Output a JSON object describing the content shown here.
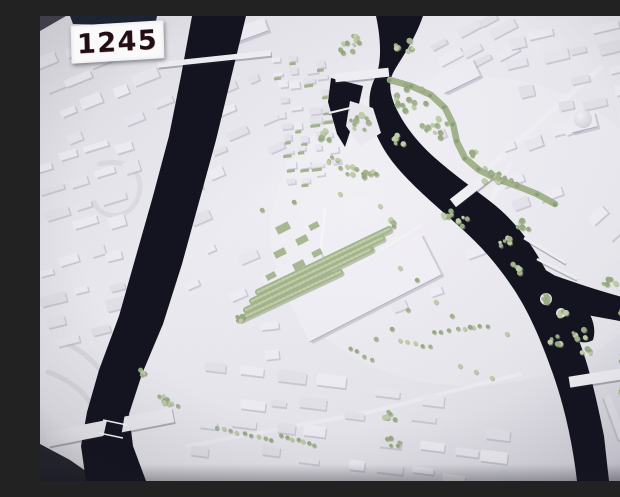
{
  "label": {
    "text": "1245"
  },
  "colors": {
    "base": "#e9e8ee",
    "base_light": "#f4f3f8",
    "base_dark": "#d9d8e0",
    "water": "#131420",
    "building": "#f1f0f6",
    "building_alt": "#ebeaf1",
    "building_dim": "#e6e5ec",
    "building_shadow": "#b4b3c1",
    "tree": "#a4b58e",
    "tree_light": "#c2cfa9",
    "tree_dark": "#879a72",
    "bridge": "#f2f1f6",
    "road": "#f7f6fa",
    "ramp": "#d9d8e0",
    "plaque": "#1e2433",
    "vignette": "#15161e",
    "card": "#fafafb",
    "card_text": "#220f16"
  },
  "scene": {
    "water": {
      "canal": "M152,0 L206,0 L191,62 L176,124 L159,186 L142,248 L123,308 L102,358 L89,398 L93,430 L106,465 L46,465 L41,430 L47,396 L59,354 L79,300 L96,240 L113,180 L129,120 L141,60 Z",
      "river": "M336,0 L383,0 C374,26 360,44 353,57 C348,67 350,80 357,94 C365,110 377,126 395,142 C413,158 433,172 451,186 C469,200 485,218 499,242 C513,266 526,292 538,322 C550,352 558,390 564,420 L569,465 L537,465 C533,430 525,392 513,358 C501,324 489,296 473,272 C457,248 441,230 421,212 C401,194 379,176 361,156 C345,138 335,120 331,102 C328,88 329,74 335,62 C341,50 342,28 336,0 Z",
      "lagoon": "M468,248 C488,242 514,256 530,272 C548,290 558,308 553,324 C541,332 519,318 503,306 C487,294 472,270 468,248 Z",
      "right_branch": "M505,256 C530,265 556,274 582,281 C596,285 610,288 620,291 L620,317 C604,311 587,306 569,303 C547,299 524,295 508,288 Z",
      "harbor": "M291,62 L323,70 L319,88 L305,131 L297,118 L288,86 Z",
      "lock_channel": "M69,395 L85,397 L79,433 L61,431 Z"
    },
    "islands": {
      "wedge": "M310,85 L333,92 L341,117 L320,130 L306,110 Z",
      "islets": [
        [
          506,
          283,
          6
        ],
        [
          521,
          297,
          5
        ]
      ]
    },
    "districts": [
      {
        "id": "top-left",
        "x": 2,
        "y": 10,
        "w": 118,
        "h": 110,
        "angle": -22,
        "cols": 4,
        "rows": 4,
        "bw": 20,
        "bh": 8,
        "density": 0.8,
        "seed": 11
      },
      {
        "id": "left-mid",
        "x": 0,
        "y": 125,
        "w": 115,
        "h": 115,
        "angle": -17,
        "cols": 4,
        "rows": 5,
        "bw": 21,
        "bh": 8,
        "density": 0.8,
        "seed": 12
      },
      {
        "id": "left-lower",
        "x": 0,
        "y": 240,
        "w": 100,
        "h": 90,
        "angle": -14,
        "cols": 3,
        "rows": 4,
        "bw": 20,
        "bh": 8,
        "density": 0.7,
        "seed": 13
      },
      {
        "id": "canal-east-upper",
        "x": 152,
        "y": 58,
        "w": 100,
        "h": 125,
        "angle": -23,
        "cols": 3,
        "rows": 5,
        "bw": 16,
        "bh": 7,
        "density": 0.6,
        "seed": 14
      },
      {
        "id": "canal-east-lower",
        "x": 135,
        "y": 188,
        "w": 92,
        "h": 110,
        "angle": -23,
        "cols": 3,
        "rows": 4,
        "bw": 15,
        "bh": 7,
        "density": 0.55,
        "seed": 15
      },
      {
        "id": "old-town",
        "x": 238,
        "y": 32,
        "w": 58,
        "h": 136,
        "angle": -7,
        "cols": 4,
        "rows": 10,
        "bw": 9,
        "bh": 5,
        "density": 0.85,
        "seed": 16,
        "greens": true
      },
      {
        "id": "top-center",
        "x": 393,
        "y": 2,
        "w": 85,
        "h": 55,
        "angle": -28,
        "cols": 3,
        "rows": 3,
        "bw": 22,
        "bh": 7,
        "density": 0.7,
        "seed": 17
      },
      {
        "id": "top-right",
        "x": 470,
        "y": 0,
        "w": 150,
        "h": 120,
        "angle": -13,
        "cols": 5,
        "rows": 5,
        "bw": 20,
        "bh": 8,
        "density": 0.78,
        "seed": 18
      },
      {
        "id": "right-mid",
        "x": 568,
        "y": 168,
        "w": 52,
        "h": 100,
        "angle": -42,
        "cols": 2,
        "rows": 4,
        "bw": 16,
        "bh": 7,
        "density": 0.7,
        "seed": 19
      },
      {
        "id": "right-low",
        "x": 572,
        "y": 325,
        "w": 48,
        "h": 138,
        "angle": 70,
        "cols": 2,
        "rows": 5,
        "bw": 22,
        "bh": 7,
        "density": 0.8,
        "seed": 20
      },
      {
        "id": "bottom-center",
        "x": 152,
        "y": 358,
        "w": 325,
        "h": 104,
        "angle": 7,
        "cols": 9,
        "rows": 4,
        "bw": 22,
        "bh": 8,
        "density": 0.72,
        "seed": 21
      },
      {
        "id": "center-east",
        "x": 342,
        "y": 228,
        "w": 125,
        "h": 100,
        "angle": -20,
        "cols": 3,
        "rows": 3,
        "bw": 16,
        "bh": 7,
        "density": 0.4,
        "seed": 22
      },
      {
        "id": "river-bend-inside",
        "x": 348,
        "y": 98,
        "w": 70,
        "h": 62,
        "angle": -25,
        "cols": 2,
        "rows": 3,
        "bw": 12,
        "bh": 6,
        "density": 0.4,
        "seed": 23
      },
      {
        "id": "east-of-river",
        "x": 452,
        "y": 108,
        "w": 105,
        "h": 80,
        "angle": -20,
        "cols": 3,
        "rows": 3,
        "bw": 18,
        "bh": 7,
        "density": 0.6,
        "seed": 24
      },
      {
        "id": "canal-delta",
        "x": 150,
        "y": 300,
        "w": 105,
        "h": 55,
        "angle": -6,
        "cols": 3,
        "rows": 2,
        "bw": 18,
        "bh": 7,
        "density": 0.5,
        "seed": 25
      }
    ],
    "landmarks": [
      {
        "id": "station-hall",
        "cx": 325,
        "cy": 272,
        "w": 148,
        "h": 46,
        "rot": -27
      },
      {
        "id": "station-annex",
        "cx": 255,
        "cy": 258,
        "w": 64,
        "h": 26,
        "rot": -27
      },
      {
        "id": "dome-base",
        "cx": 543,
        "cy": 106,
        "w": 26,
        "h": 16,
        "rot": -14
      },
      {
        "id": "tall-slab",
        "cx": 152,
        "cy": 162,
        "w": 14,
        "h": 24,
        "rot": -18
      },
      {
        "id": "big-block",
        "cx": 210,
        "cy": 14,
        "w": 34,
        "h": 14,
        "rot": -20
      },
      {
        "id": "white-hall",
        "cx": 418,
        "cy": 60,
        "w": 40,
        "h": 20,
        "rot": -26
      }
    ],
    "dome": {
      "cx": 543,
      "cy": 103,
      "r": 9
    },
    "bridges": [
      {
        "id": "canal-bridge",
        "cx": 174,
        "cy": 43,
        "w": 114,
        "h": 5.5,
        "rot": -6
      },
      {
        "id": "upper-bridge",
        "cx": 322,
        "cy": 59,
        "w": 54,
        "h": 9,
        "rot": -6
      },
      {
        "id": "central-bridge",
        "cx": 431,
        "cy": 173,
        "w": 46,
        "h": 10,
        "rot": -38
      },
      {
        "id": "lower-bridge",
        "cx": 562,
        "cy": 361,
        "w": 66,
        "h": 11,
        "rot": -9
      },
      {
        "id": "lock-road",
        "cx": 70,
        "cy": 411,
        "w": 128,
        "h": 15,
        "rot": -11
      }
    ],
    "footbridges": [
      [
        484,
        222,
        526,
        247,
        2.5
      ],
      [
        497,
        243,
        537,
        263,
        2.5
      ],
      [
        600,
        277,
        614,
        306,
        4
      ],
      [
        289,
        97,
        310,
        92,
        2
      ]
    ],
    "lock_gates": [
      [
        63,
        404,
        87,
        409,
        1.6
      ],
      [
        59,
        417,
        83,
        422,
        1.6
      ]
    ],
    "green_strips": [
      [
        218,
        276,
        349,
        213
      ],
      [
        212,
        285,
        342,
        222
      ],
      [
        206,
        294,
        331,
        233
      ],
      [
        202,
        302,
        300,
        256
      ]
    ],
    "allee": [
      [
        350,
        64
      ],
      [
        371,
        70
      ],
      [
        391,
        79
      ],
      [
        405,
        92
      ],
      [
        413,
        108
      ],
      [
        417,
        126
      ],
      [
        425,
        142
      ],
      [
        439,
        154
      ],
      [
        457,
        163
      ],
      [
        477,
        170
      ],
      [
        497,
        178
      ],
      [
        515,
        188
      ]
    ],
    "tree_rows": [
      [
        176,
        412,
        232,
        424,
        9
      ],
      [
        241,
        420,
        275,
        429,
        7
      ],
      [
        394,
        316,
        448,
        310,
        8
      ],
      [
        310,
        332,
        331,
        344,
        4
      ],
      [
        360,
        325,
        390,
        331,
        5
      ],
      [
        444,
        152,
        477,
        167,
        6
      ],
      [
        585,
        250,
        612,
        262,
        5
      ],
      [
        120,
        381,
        138,
        390,
        4
      ]
    ],
    "tree_clusters": [
      [
        310,
        28,
        14,
        11
      ],
      [
        364,
        30,
        10,
        7
      ],
      [
        318,
        106,
        12,
        9
      ],
      [
        285,
        120,
        7,
        5
      ],
      [
        293,
        146,
        7,
        5
      ],
      [
        372,
        82,
        18,
        14
      ],
      [
        394,
        112,
        14,
        10
      ],
      [
        358,
        122,
        10,
        7
      ],
      [
        308,
        152,
        9,
        7
      ],
      [
        331,
        161,
        9,
        6
      ],
      [
        452,
        160,
        11,
        8
      ],
      [
        408,
        198,
        8,
        6
      ],
      [
        424,
        207,
        8,
        5
      ],
      [
        462,
        226,
        9,
        6
      ],
      [
        479,
        252,
        8,
        6
      ],
      [
        506,
        283,
        6,
        5
      ],
      [
        521,
        297,
        5,
        4
      ],
      [
        540,
        318,
        8,
        6
      ],
      [
        515,
        325,
        7,
        5
      ],
      [
        570,
        268,
        7,
        5
      ],
      [
        589,
        273,
        6,
        4
      ],
      [
        578,
        297,
        6,
        4
      ],
      [
        546,
        336,
        6,
        4
      ],
      [
        585,
        343,
        7,
        5
      ],
      [
        583,
        376,
        5,
        3
      ],
      [
        352,
        400,
        8,
        6
      ],
      [
        353,
        426,
        7,
        5
      ],
      [
        126,
        384,
        6,
        5
      ],
      [
        103,
        357,
        5,
        4
      ],
      [
        200,
        305,
        6,
        4
      ],
      [
        352,
        207,
        5,
        4
      ],
      [
        484,
        209,
        7,
        5
      ],
      [
        436,
        137,
        6,
        4
      ]
    ],
    "tree_singles": [
      [
        360,
        252
      ],
      [
        377,
        264
      ],
      [
        396,
        286
      ],
      [
        368,
        294
      ],
      [
        412,
        300
      ],
      [
        430,
        311
      ],
      [
        352,
        313
      ],
      [
        336,
        323
      ],
      [
        420,
        350
      ],
      [
        436,
        356
      ],
      [
        452,
        362
      ],
      [
        467,
        318
      ],
      [
        300,
        178
      ],
      [
        340,
        190
      ],
      [
        254,
        186
      ],
      [
        222,
        194
      ]
    ],
    "courtyards": [
      [
        243,
        212,
        14,
        8
      ],
      [
        262,
        224,
        12,
        7
      ],
      [
        240,
        237,
        12,
        7
      ],
      [
        259,
        249,
        12,
        7
      ],
      [
        277,
        237,
        10,
        6
      ],
      [
        274,
        210,
        10,
        6
      ],
      [
        231,
        260,
        10,
        6
      ]
    ],
    "roads": [
      {
        "pts": [
          [
            285,
            192
          ],
          [
            273,
            307
          ]
        ],
        "w": 2.5,
        "o": 0.85
      },
      {
        "pts": [
          [
            451,
            149
          ],
          [
            560,
            52
          ]
        ],
        "w": 5,
        "o": 0.5
      },
      {
        "pts": [
          [
            380,
            210
          ],
          [
            302,
            258
          ]
        ],
        "w": 3,
        "o": 0.45
      },
      {
        "pts": [
          [
            148,
            430
          ],
          [
            330,
            396
          ],
          [
            480,
            358
          ]
        ],
        "w": 4,
        "o": 0.5
      },
      {
        "pts": [
          [
            332,
            56
          ],
          [
            296,
            61
          ]
        ],
        "w": 4,
        "o": 0.6
      },
      {
        "pts": [
          [
            450,
            186
          ],
          [
            470,
            148
          ]
        ],
        "w": 5,
        "o": 0.55
      }
    ],
    "ramps": [
      "M28,328 C58,344 78,368 68,402",
      "M8,356 C40,368 62,390 54,418",
      "M60,148 C92,140 108,162 96,186 C86,204 62,204 54,186"
    ],
    "fx": {
      "bottom_left_wedge": "M0,428 L30,444 L60,465 L0,465 Z",
      "top_left_wedge": "M0,0 L26,0 L0,15 Z",
      "plaque_bar": "M30,0 L117,0 L115,10 L33,8 Z"
    }
  }
}
